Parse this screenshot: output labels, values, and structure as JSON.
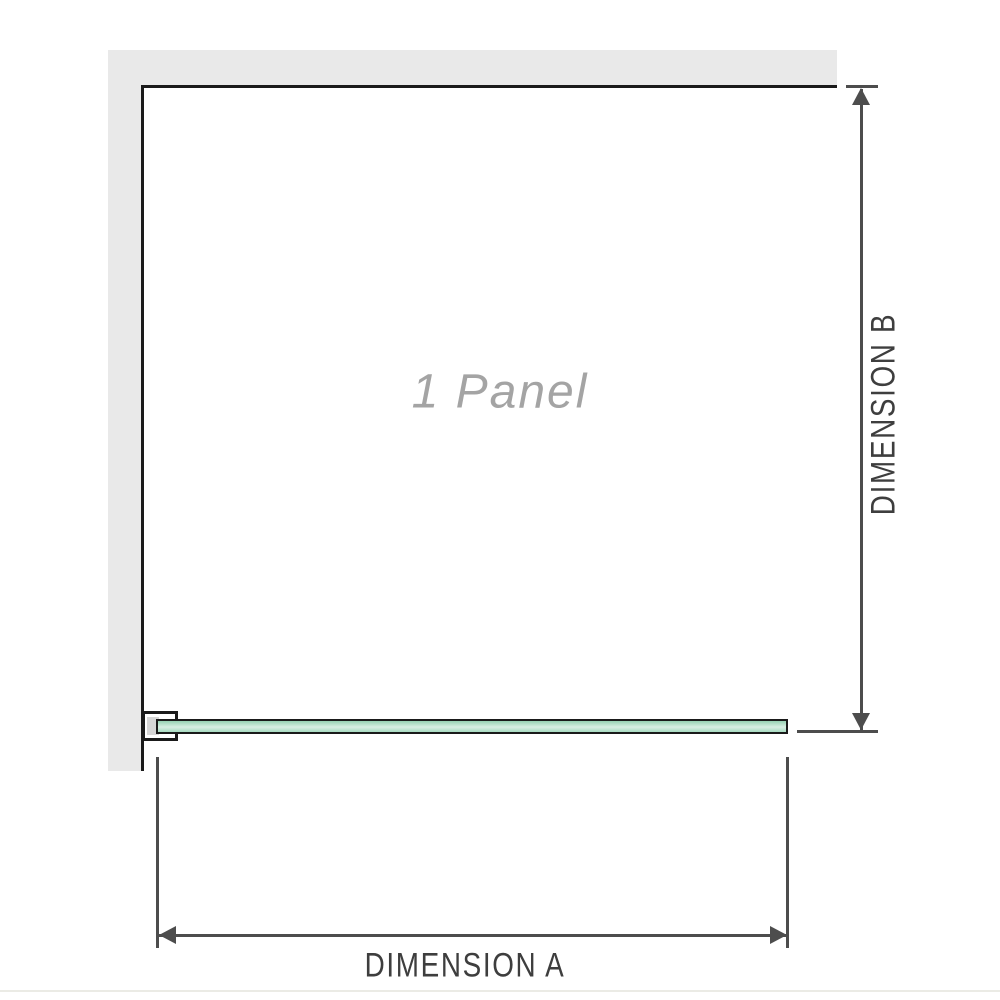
{
  "diagram": {
    "panel_label": "1 Panel",
    "dimensions": {
      "horizontal_label": "DIMENSION A",
      "vertical_label": "DIMENSION B"
    }
  },
  "colors": {
    "wall": "#e9e9e9",
    "outline": "#1a1a1a",
    "dimension": "#4d4d4d",
    "label_text": "#3e3e3e",
    "panel_label_text": "#a4a4a4",
    "glass_top": "#96d1b2",
    "glass_mid": "#d8eee3",
    "glass_bottom": "#a7dbc1",
    "footer_line": "#ebebe5"
  }
}
